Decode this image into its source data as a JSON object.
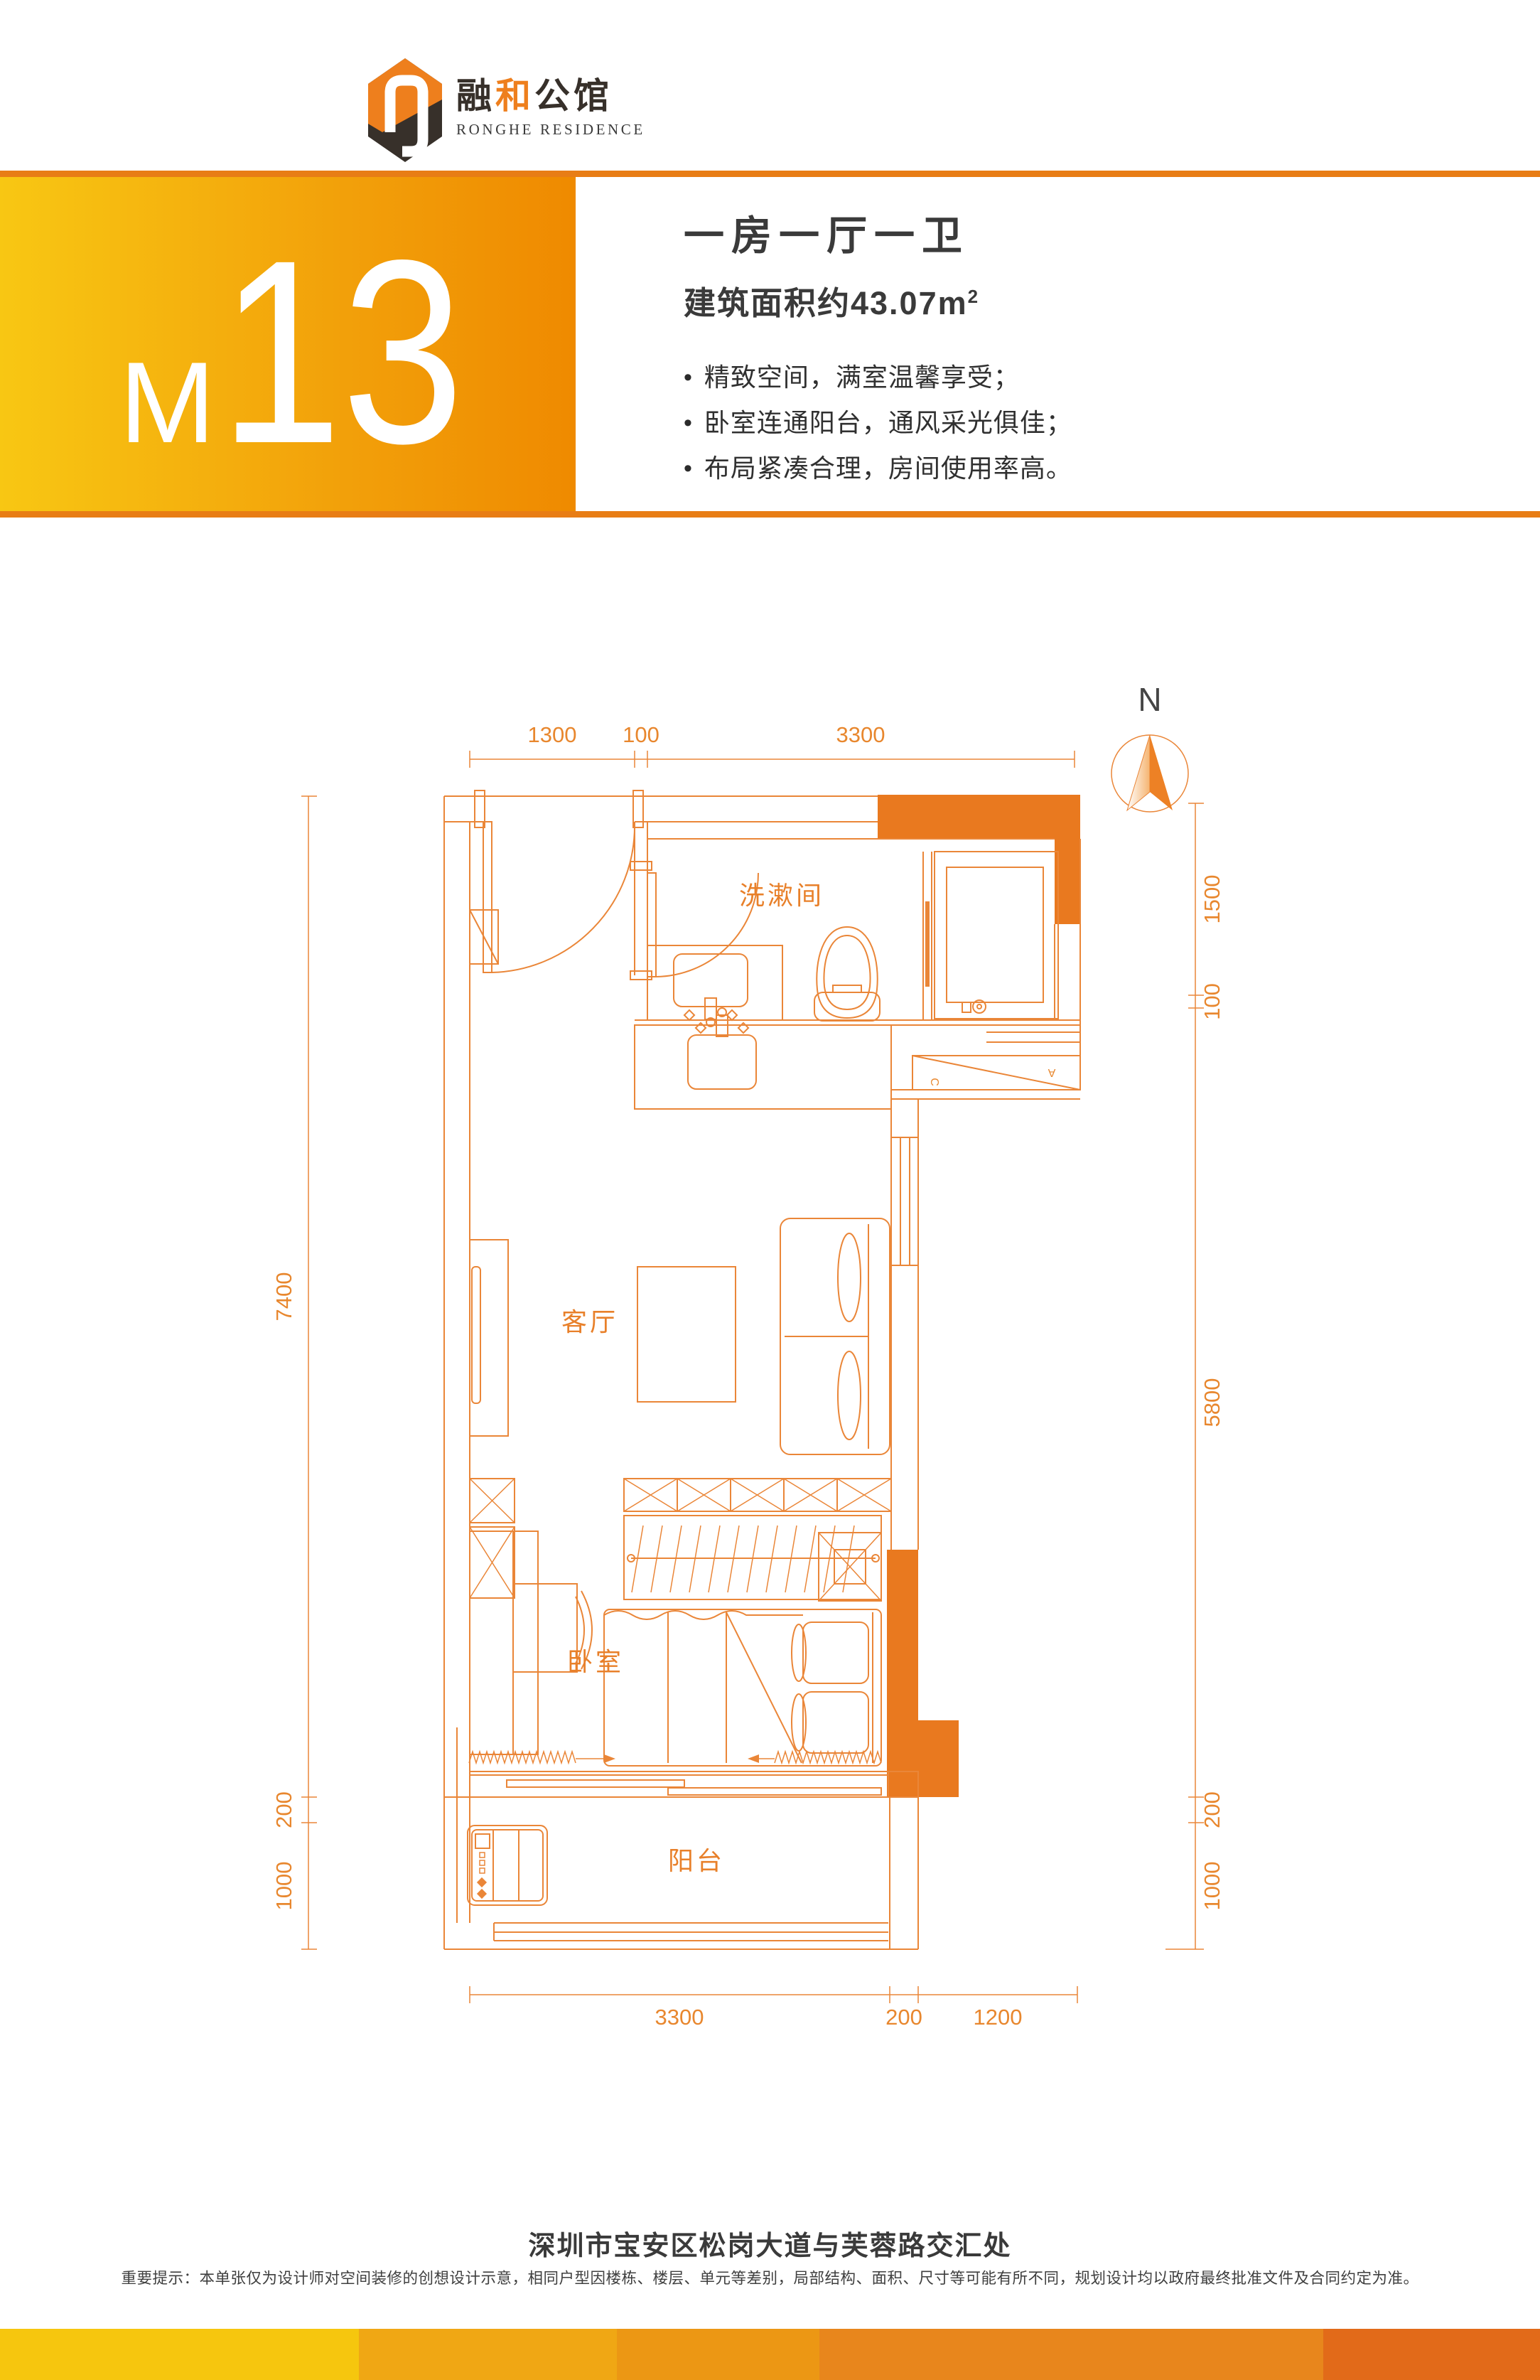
{
  "brand": {
    "name_part1": "融",
    "name_part2": "和",
    "name_part3": "公馆",
    "subtitle": "RONGHE RESIDENCE"
  },
  "header": {
    "unit_letter": "M",
    "unit_number": "13",
    "title": "一房一厅一卫",
    "area": "建筑面积约43.07m",
    "area_sup": "2",
    "bullets": [
      "精致空间，满室温馨享受；",
      "卧室连通阳台，通风采光俱佳；",
      "布局紧凑合理，房间使用率高。"
    ]
  },
  "plan": {
    "compass_label": "N",
    "rooms": {
      "bathroom": "洗漱间",
      "living": "客厅",
      "bedroom": "卧室",
      "balcony": "阳台"
    },
    "dims_top": [
      "1300",
      "100",
      "3300"
    ],
    "dims_right": [
      "1500",
      "100",
      "5800",
      "200",
      "1000"
    ],
    "dims_left": [
      "7400",
      "200",
      "1000"
    ],
    "dims_bottom": [
      "3300",
      "200",
      "1200"
    ],
    "ac_letters": [
      "A",
      "C"
    ]
  },
  "footer": {
    "address": "深圳市宝安区松岗大道与芙蓉路交汇处",
    "disclaimer": "重要提示：本单张仅为设计师对空间装修的创想设计示意，相同户型因楼栋、楼层、单元等差别，局部结构、面积、尺寸等可能有所不同，规划设计均以政府最终批准文件及合同约定为准。"
  },
  "colors": {
    "line": "#EA8638",
    "dim_text": "#E8872E",
    "room_label": "#E8802A",
    "wall_fill": "#E9791F",
    "band_line": "#E87D15",
    "gradient_start": "#F8C713",
    "gradient_end": "#EF8A00",
    "logo_dark": "#37302A",
    "logo_orange": "#EE7F1D",
    "text_dark": "#3A3A3A",
    "stripe": [
      "#F6C60E",
      "#F0A714",
      "#EC9714",
      "#E8861C",
      "#E26A19"
    ]
  }
}
